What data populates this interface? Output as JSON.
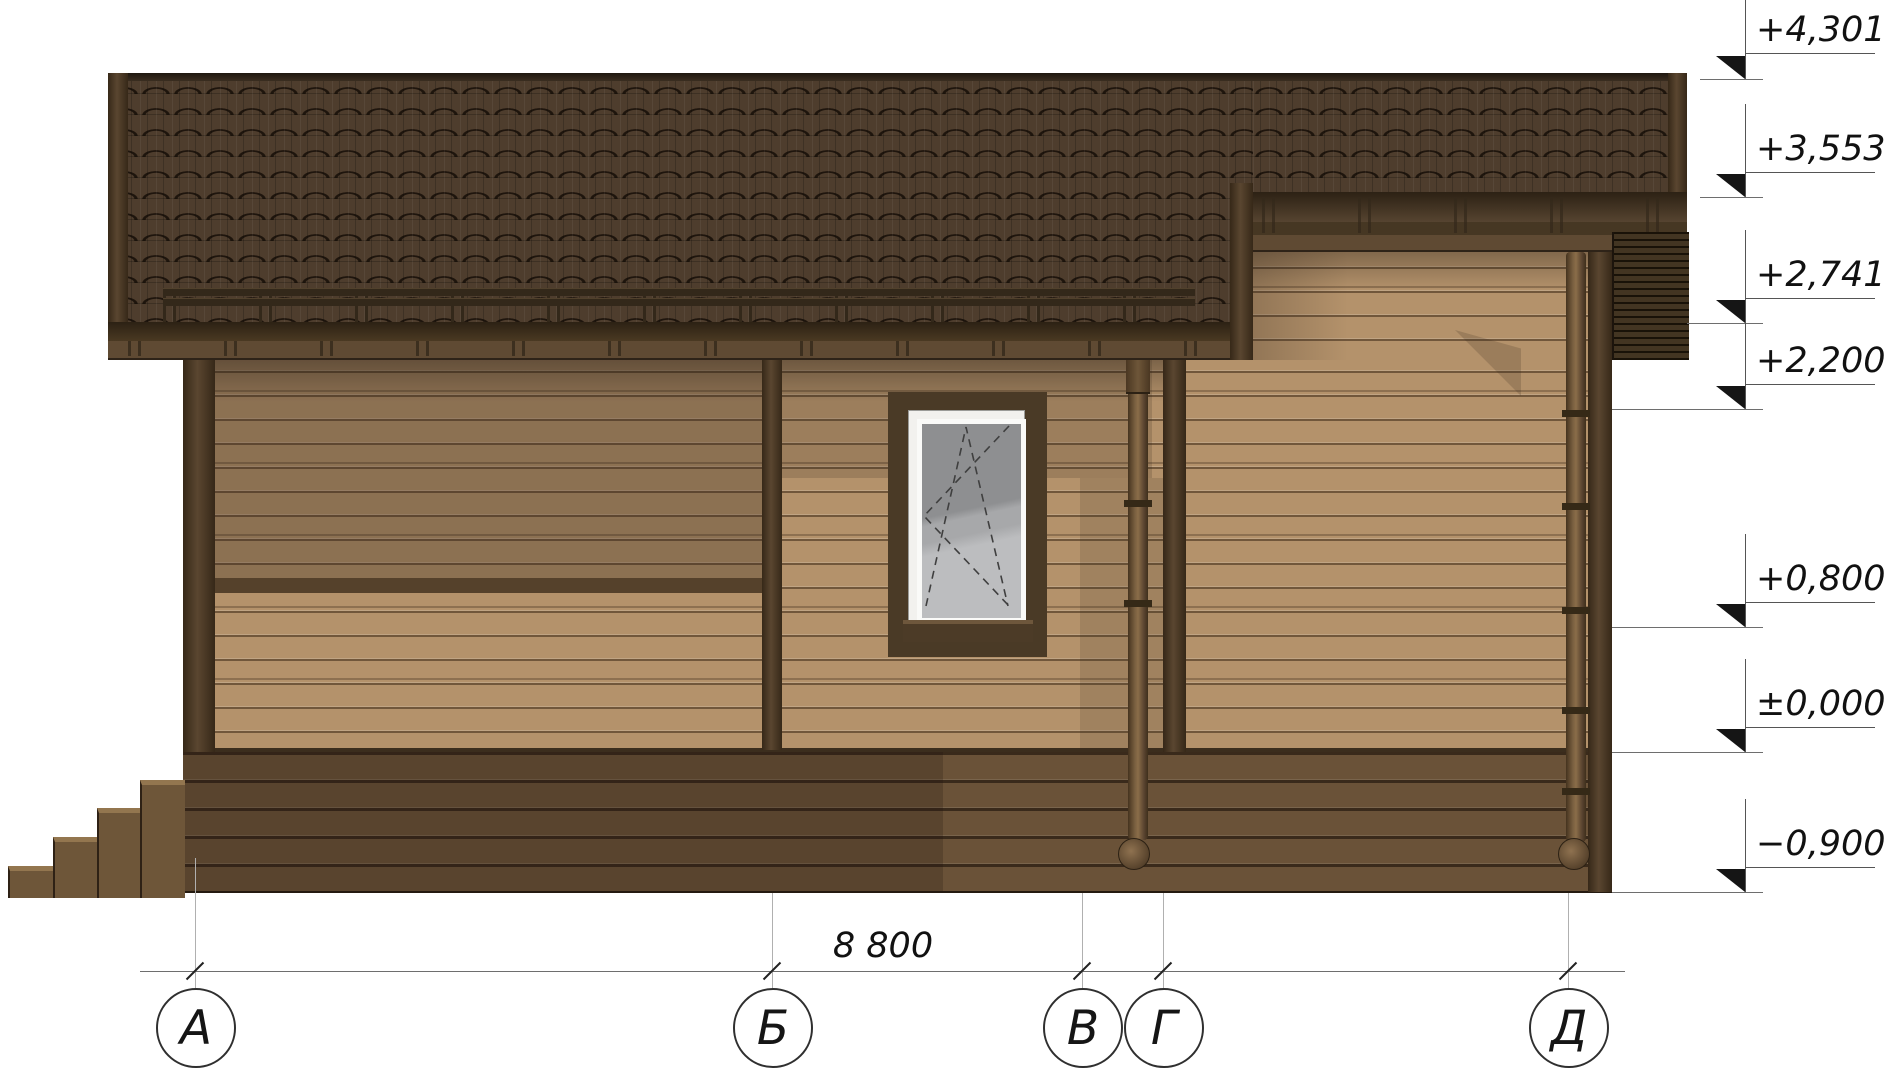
{
  "drawing": {
    "type": "architectural-elevation",
    "axes": {
      "items": [
        {
          "label": "А"
        },
        {
          "label": "Б"
        },
        {
          "label": "В"
        },
        {
          "label": "Г"
        },
        {
          "label": "Д"
        }
      ],
      "total_dimension": "8 800"
    },
    "levels": {
      "items": [
        {
          "label": "+4,301"
        },
        {
          "label": "+3,553"
        },
        {
          "label": "+2,741"
        },
        {
          "label": "+2,200"
        },
        {
          "label": "+0,800"
        },
        {
          "label": "±0,000"
        },
        {
          "label": "−0,900"
        }
      ]
    },
    "colors": {
      "roof": "#4e3d2d",
      "wall": "#b4926b",
      "plinth": "#6a5238",
      "trim": "#4a3926",
      "window_glass": "#9a9b9d",
      "marker": "#151515"
    }
  }
}
